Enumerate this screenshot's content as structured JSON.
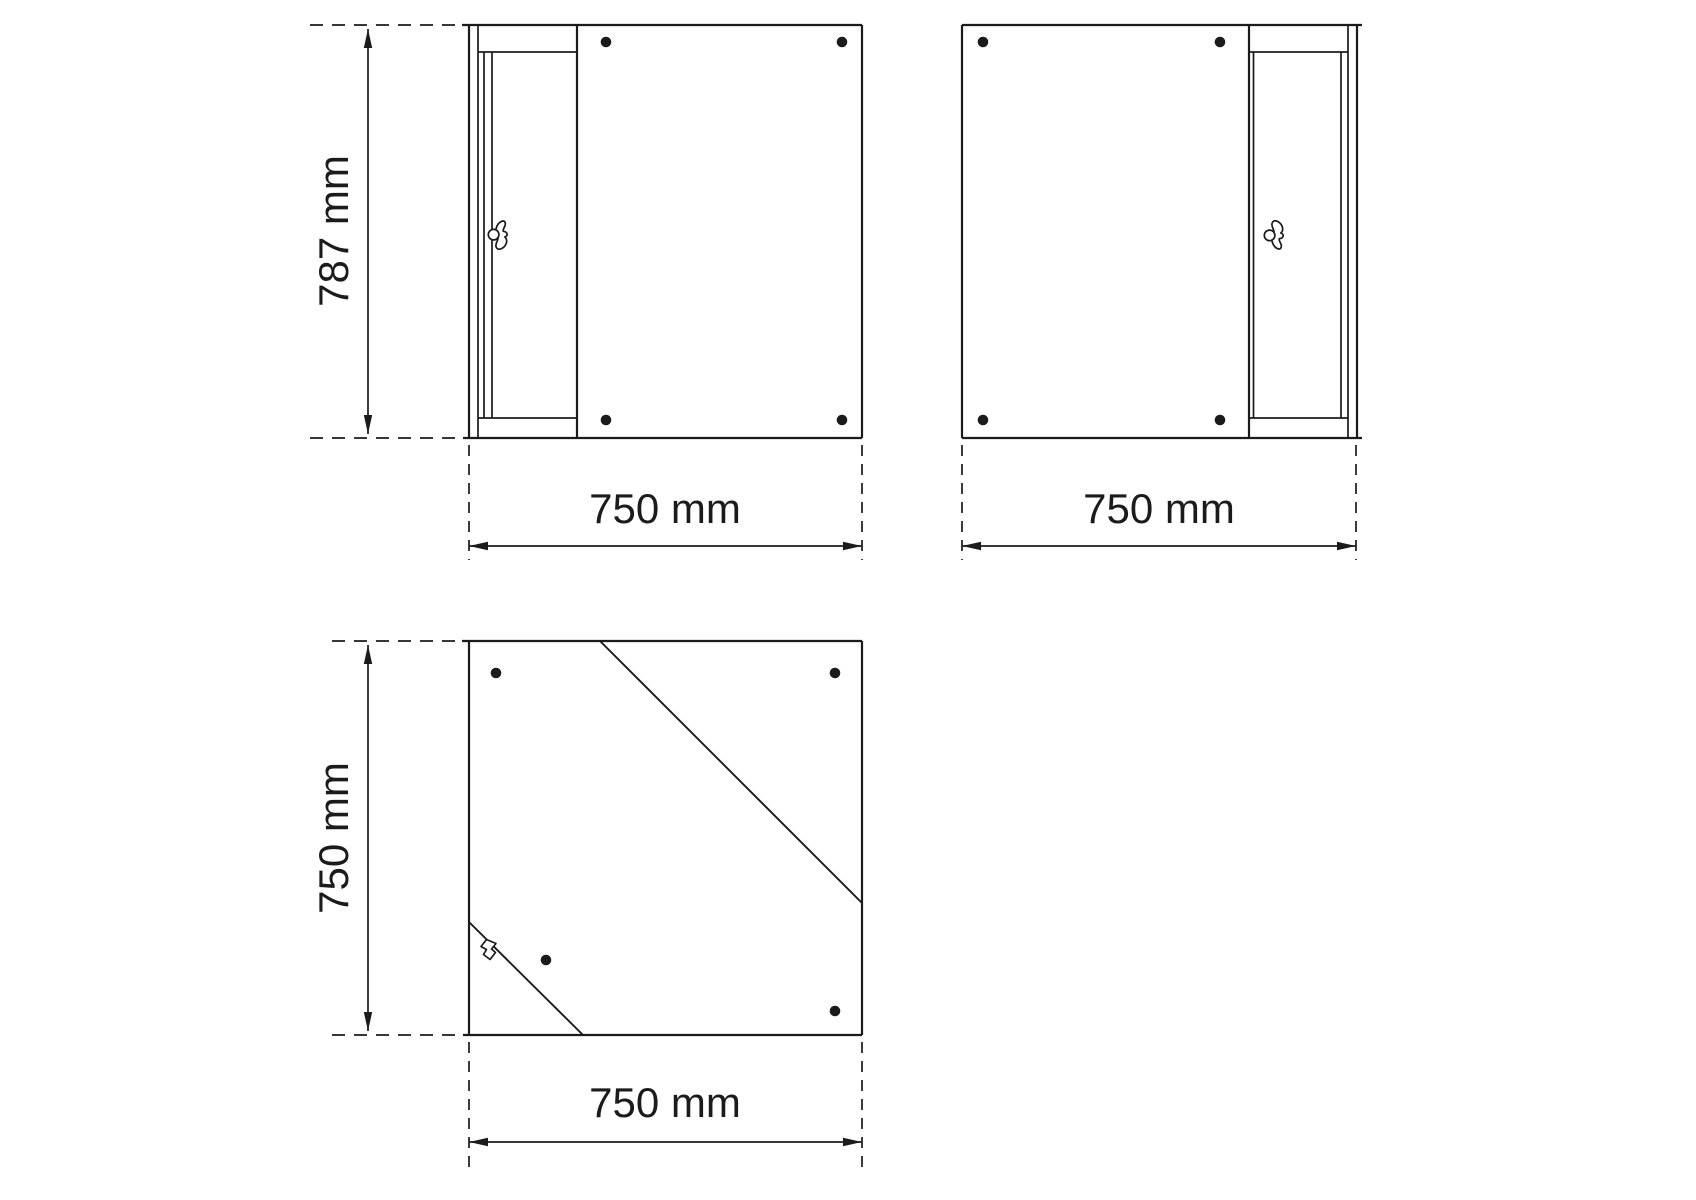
{
  "drawing": {
    "background_color": "#ffffff",
    "line_color": "#1b1b1b",
    "views": {
      "side_left_door": "cabinet elevation, door on left",
      "side_right_door": "cabinet elevation, door on right",
      "top_view": "cabinet top view with fold diagonals"
    },
    "icons": {
      "key_handle": "butterfly-key",
      "screw_hole": "round-dot"
    },
    "labels": {
      "view1_height": "787 mm",
      "view1_width": "750 mm",
      "view2_width": "750 mm",
      "view3_depth": "750 mm",
      "view3_width": "750 mm"
    }
  }
}
